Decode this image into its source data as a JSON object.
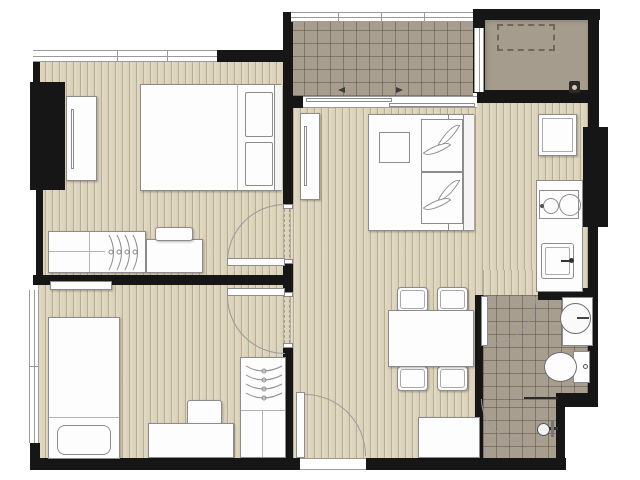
{
  "document": {
    "type": "architectural-floor-plan",
    "description": "top-down rendered apartment floor plan, no text labels visible"
  },
  "colors": {
    "wall": "#161616",
    "wood_base": "#d8cfb7",
    "wood_stripe": "#b9ae94",
    "wood_light": "#e2dac4",
    "tile_base": "#a89e90",
    "ac_base": "#a59c8e",
    "furniture_fill": "#fdfdfd",
    "furniture_line": "#8c8c8c",
    "arc_line": "#9a9a9a",
    "window_line": "#9a9a9a",
    "dashed_line": "#6f675c",
    "partition_dark": "#2a2a2a",
    "background": "#ffffff"
  },
  "rooms": [
    {
      "id": "bedroom-top-left",
      "floor": "wood-plank",
      "furniture": [
        "wardrobe",
        "double-bed",
        "pillow",
        "pillow",
        "low-dresser-with-hangers",
        "side-table",
        "tray"
      ],
      "openings": [
        "top-window-band",
        "swing-door-to-hall"
      ]
    },
    {
      "id": "bedroom-bottom-left",
      "floor": "wood-plank",
      "furniture": [
        "single-bed",
        "pillow",
        "wall-shelf",
        "desk",
        "chair",
        "wardrobe-with-hangers"
      ],
      "openings": [
        "left-window-band",
        "swing-door-to-hall"
      ]
    },
    {
      "id": "living-dining-area",
      "floor": "wood-plank",
      "furniture": [
        "side-cabinet",
        "double-bed-with-leaf-pillows",
        "dining-table",
        {
          "name": "dining-chair",
          "count": 4
        },
        "entry-cabinet"
      ],
      "openings": [
        "entrance-swing-door",
        "sliding-door-to-balcony",
        "opening-to-bathroom"
      ]
    },
    {
      "id": "kitchen-strip",
      "floor": "wood-plank",
      "furniture": [
        "refrigerator",
        "counter",
        "two-burner-stove",
        "sink-with-faucet"
      ]
    },
    {
      "id": "bathroom",
      "floor": "tile-grid",
      "fixtures": [
        "vanity-with-round-basin",
        "faucet",
        "toilet-with-tank",
        "flush-button",
        "shower-partition",
        "shower-swing-door",
        "shower-head"
      ],
      "openings": [
        "swing-door"
      ]
    },
    {
      "id": "balcony",
      "floor": "tile-grid",
      "features": [
        "railing-band",
        "sliding-door-two-panels",
        "slide-direction-arrows",
        "door-to-ac-ledge"
      ]
    },
    {
      "id": "ac-ledge",
      "floor": "plain-concrete",
      "features": [
        "condenser-dashed-outline",
        "floor-drain"
      ]
    }
  ],
  "walls": {
    "style": "solid-black-poche",
    "doors": "quarter-circle-swing-arcs",
    "beam_over_hall": "dashed-double-line"
  }
}
